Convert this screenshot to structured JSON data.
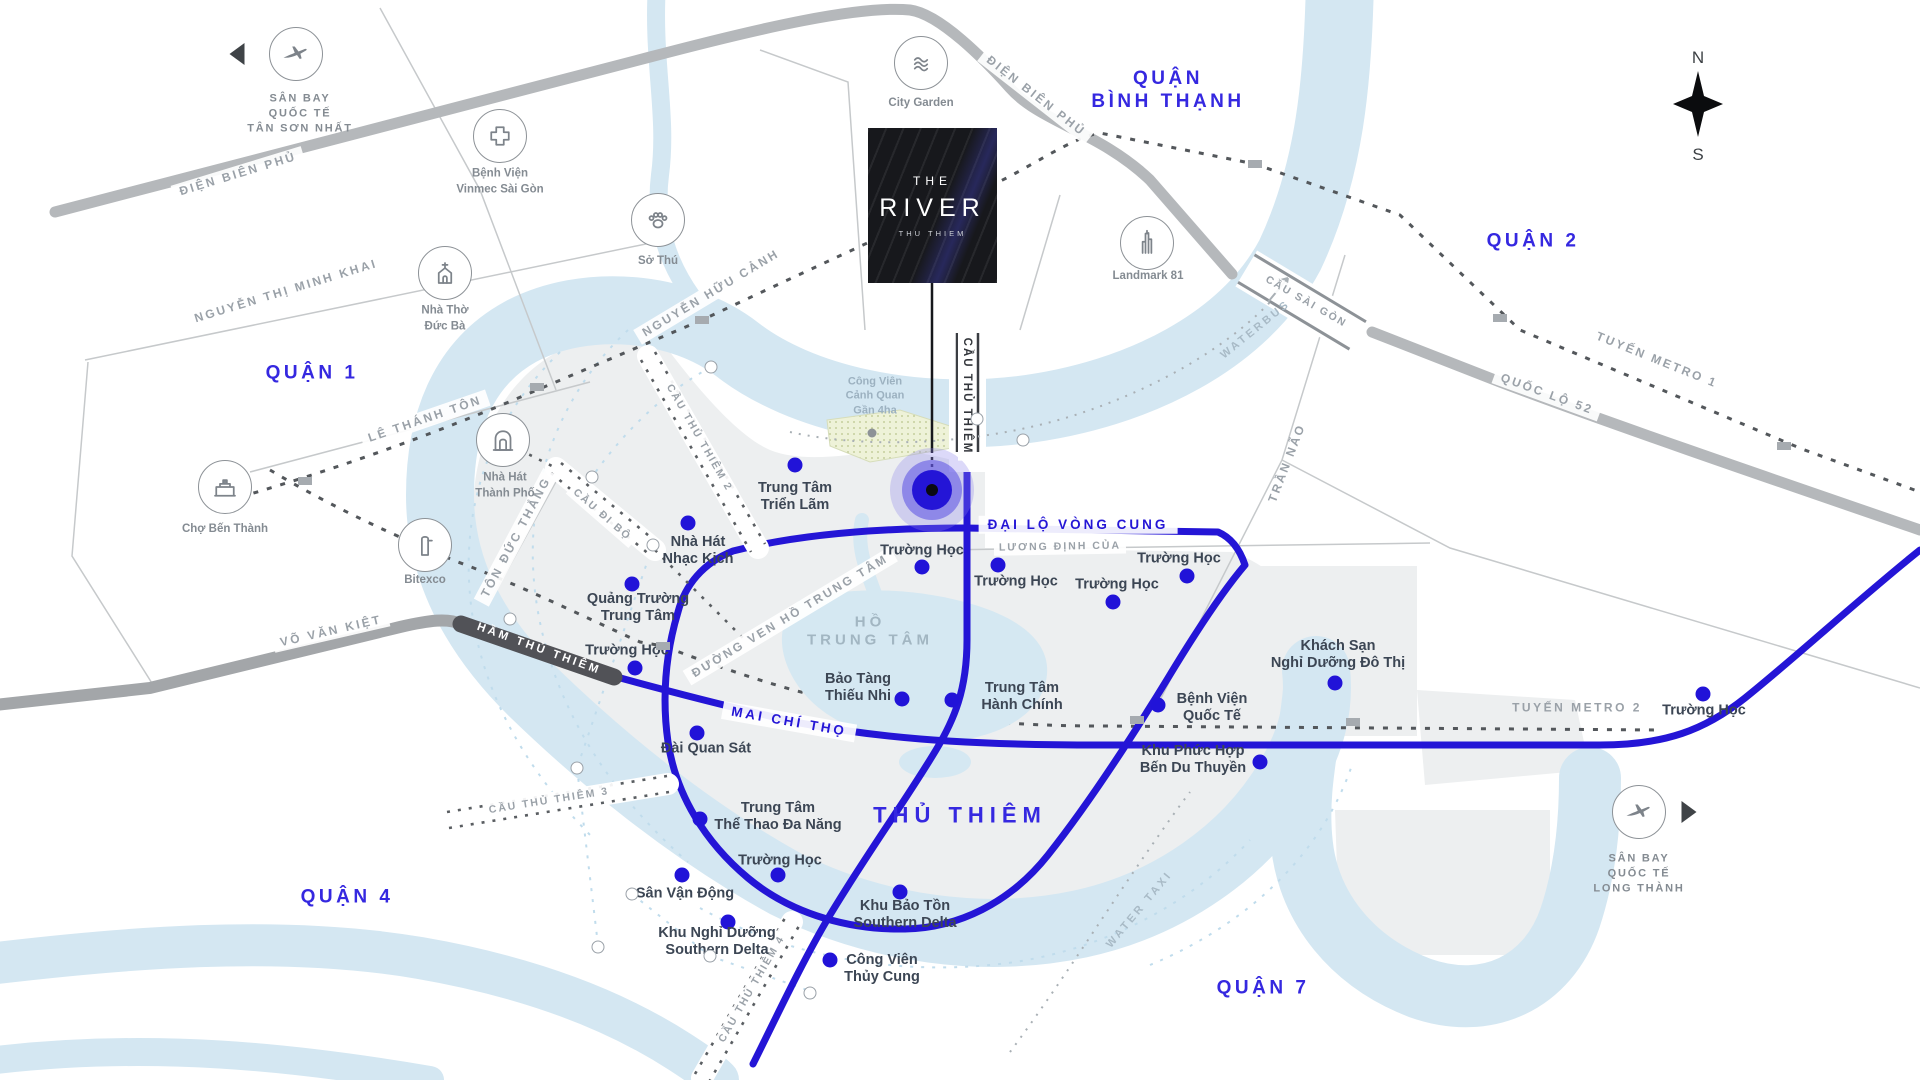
{
  "title": "THE RIVER Thu Thiem location map",
  "logo": {
    "line1": "THE",
    "line2": "RIVER",
    "line3": "THU THIEM"
  },
  "compass": {
    "north": "N",
    "south": "S"
  },
  "colors": {
    "accent_road": "#2415d6",
    "district_text": "#3528e0",
    "river": "#d4e7f2",
    "land": "#edeff0",
    "tunnel": "#515257"
  },
  "districts": [
    {
      "lines": [
        "QUẬN 1"
      ],
      "x": 312,
      "y": 373
    },
    {
      "lines": [
        "QUẬN 2"
      ],
      "x": 1533,
      "y": 241
    },
    {
      "lines": [
        "QUẬN",
        "BÌNH THẠNH"
      ],
      "x": 1168,
      "y": 90
    },
    {
      "lines": [
        "QUẬN 4"
      ],
      "x": 347,
      "y": 897
    },
    {
      "lines": [
        "QUẬN 7"
      ],
      "x": 1263,
      "y": 988
    }
  ],
  "area_labels": [
    {
      "lines": [
        "HỒ",
        "TRUNG TÂM"
      ],
      "x": 870,
      "y": 632,
      "cls": "lake-lbl"
    },
    {
      "lines": [
        "THỦ THIÊM"
      ],
      "x": 960,
      "y": 816,
      "cls": "bigblue"
    },
    {
      "lines": [
        "Công Viên",
        "Cảnh Quan",
        "Gần 4ha"
      ],
      "x": 875,
      "y": 396,
      "cls": "park-lbl"
    }
  ],
  "road_labels": [
    {
      "t": "ĐIỆN BIÊN PHỦ",
      "x": 238,
      "y": 174,
      "r": -17,
      "c": ""
    },
    {
      "t": "ĐIỆN BIÊN PHỦ",
      "x": 1036,
      "y": 96,
      "r": 38,
      "c": ""
    },
    {
      "t": "NGUYỄN THỊ MINH KHAI",
      "x": 286,
      "y": 291,
      "r": -17,
      "c": ""
    },
    {
      "t": "NGUYỄN HỮU CẢNH",
      "x": 711,
      "y": 293,
      "r": -31,
      "c": ""
    },
    {
      "t": "LÊ THÁNH TÔN",
      "x": 425,
      "y": 419,
      "r": -19,
      "c": ""
    },
    {
      "t": "TÔN ĐỨC THẮNG",
      "x": 516,
      "y": 537,
      "r": -62,
      "c": ""
    },
    {
      "t": "VÕ VĂN KIỆT",
      "x": 331,
      "y": 631,
      "r": -13,
      "c": ""
    },
    {
      "t": "QUỐC LỘ 52",
      "x": 1547,
      "y": 394,
      "r": 20,
      "c": ""
    },
    {
      "t": "CẦU SÀI GÒN",
      "x": 1306,
      "y": 302,
      "r": 30,
      "c": "gs"
    },
    {
      "t": "TUYẾN METRO 1",
      "x": 1657,
      "y": 360,
      "r": 22,
      "c": "gn"
    },
    {
      "t": "TUYẾN METRO 2",
      "x": 1577,
      "y": 708,
      "r": 0,
      "c": "gn"
    },
    {
      "t": "TRẦN NÃO",
      "x": 1287,
      "y": 463,
      "r": -69,
      "c": "gn"
    },
    {
      "t": "LƯƠNG ĐỊNH CỦA",
      "x": 1060,
      "y": 547,
      "r": -1,
      "c": "gs"
    },
    {
      "t": "ĐƯỜNG VEN HỒ TRUNG TÂM",
      "x": 790,
      "y": 616,
      "r": -31,
      "c": ""
    },
    {
      "t": "WATERBUS",
      "x": 1256,
      "y": 330,
      "r": -39,
      "c": "w"
    },
    {
      "t": "WATER TAXI",
      "x": 1140,
      "y": 910,
      "r": -50,
      "c": "w"
    },
    {
      "t": "CẦU ĐI BỘ",
      "x": 602,
      "y": 515,
      "r": 41,
      "c": "gs"
    },
    {
      "t": "CẦU THỦ THIÊM 2",
      "x": 699,
      "y": 438,
      "r": 60,
      "c": "gs"
    },
    {
      "t": "CẦU THỦ THIÊM 3",
      "x": 549,
      "y": 801,
      "r": -9,
      "c": "gs"
    },
    {
      "t": "CẦU THỦ THIÊM 4",
      "x": 752,
      "y": 989,
      "r": -60,
      "c": "gs"
    },
    {
      "t": "MAI CHÍ THỌ",
      "x": 789,
      "y": 722,
      "r": 10,
      "c": "b"
    },
    {
      "t": "ĐẠI LỘ VÒNG CUNG",
      "x": 1078,
      "y": 525,
      "r": 0,
      "c": "b"
    },
    {
      "t": "HẦM THỦ THIÊM",
      "x": 539,
      "y": 649,
      "r": 20,
      "c": "tun"
    },
    {
      "t": "CẦU THỦ THIÊM",
      "x": 967,
      "y": 396,
      "r": 0,
      "c": "vert"
    }
  ],
  "pois": [
    {
      "lines": [
        "Trung Tâm",
        "Triển Lãm"
      ],
      "dx": 795,
      "dy": 465,
      "lx": 795,
      "ly": 497
    },
    {
      "lines": [
        "Nhà Hát",
        "Nhạc Kịch"
      ],
      "dx": 688,
      "dy": 523,
      "lx": 698,
      "ly": 551
    },
    {
      "lines": [
        "Quảng Trường",
        "Trung Tâm"
      ],
      "dx": 632,
      "dy": 584,
      "lx": 638,
      "ly": 608
    },
    {
      "lines": [
        "Trường Học"
      ],
      "dx": 635,
      "dy": 668,
      "lx": 627,
      "ly": 651
    },
    {
      "lines": [
        "Bảo Tàng",
        "Thiếu Nhi"
      ],
      "dx": 902,
      "dy": 699,
      "lx": 858,
      "ly": 688
    },
    {
      "lines": [
        "Trung Tâm",
        "Hành Chính"
      ],
      "dx": 952,
      "dy": 700,
      "lx": 1022,
      "ly": 697
    },
    {
      "lines": [
        "Trường Học"
      ],
      "dx": 922,
      "dy": 567,
      "lx": 922,
      "ly": 551
    },
    {
      "lines": [
        "Trường Học"
      ],
      "dx": 998,
      "dy": 565,
      "lx": 1016,
      "ly": 582
    },
    {
      "lines": [
        "Trường Học"
      ],
      "dx": 1113,
      "dy": 602,
      "lx": 1117,
      "ly": 585
    },
    {
      "lines": [
        "Trường Học"
      ],
      "dx": 1187,
      "dy": 576,
      "lx": 1179,
      "ly": 559
    },
    {
      "lines": [
        "Trường Học"
      ],
      "dx": 1703,
      "dy": 694,
      "lx": 1704,
      "ly": 711
    },
    {
      "lines": [
        "Bệnh Viện",
        "Quốc Tế"
      ],
      "dx": 1158,
      "dy": 705,
      "lx": 1212,
      "ly": 708
    },
    {
      "lines": [
        "Khách Sạn",
        "Nghỉ Dưỡng Đô Thị"
      ],
      "dx": 1335,
      "dy": 683,
      "lx": 1338,
      "ly": 655
    },
    {
      "lines": [
        "Khu Phức Hợp",
        "Bến Du Thuyền"
      ],
      "dx": 1260,
      "dy": 762,
      "lx": 1193,
      "ly": 760
    },
    {
      "lines": [
        "Đài Quan Sát"
      ],
      "dx": 697,
      "dy": 733,
      "lx": 706,
      "ly": 749
    },
    {
      "lines": [
        "Trung Tâm",
        "Thể Thao Đa Năng"
      ],
      "dx": 700,
      "dy": 819,
      "lx": 778,
      "ly": 817
    },
    {
      "lines": [
        "Trường Học"
      ],
      "dx": 778,
      "dy": 875,
      "lx": 780,
      "ly": 861
    },
    {
      "lines": [
        "Sân Vận Động"
      ],
      "dx": 682,
      "dy": 875,
      "lx": 685,
      "ly": 894
    },
    {
      "lines": [
        "Khu Nghỉ Dưỡng",
        "Southern Delta"
      ],
      "dx": 728,
      "dy": 922,
      "lx": 717,
      "ly": 942
    },
    {
      "lines": [
        "Khu Bảo Tồn",
        "Southern Delta"
      ],
      "dx": 900,
      "dy": 892,
      "lx": 905,
      "ly": 915
    },
    {
      "lines": [
        "Công Viên",
        "Thủy Cung"
      ],
      "dx": 830,
      "dy": 960,
      "lx": 882,
      "ly": 969
    }
  ],
  "landmarks": [
    {
      "icon": "airplane-icon",
      "lines": [
        "SÂN BAY",
        "QUỐC TẾ",
        "TÂN SƠN NHẤT"
      ],
      "ix": 296,
      "iy": 54,
      "lx": 300,
      "ly": 114,
      "upper": true,
      "arrow": "left",
      "ax": 237,
      "ay": 54
    },
    {
      "icon": "hospital-cross-icon",
      "lines": [
        "Bệnh Viện",
        "Vinmec Sài Gòn"
      ],
      "ix": 500,
      "iy": 136,
      "lx": 500,
      "ly": 182
    },
    {
      "icon": "paw-icon",
      "lines": [
        "Sở Thú"
      ],
      "ix": 658,
      "iy": 220,
      "lx": 658,
      "ly": 262
    },
    {
      "icon": "church-icon",
      "lines": [
        "Nhà Thờ",
        "Đức Bà"
      ],
      "ix": 445,
      "iy": 273,
      "lx": 445,
      "ly": 319
    },
    {
      "icon": "theater-icon",
      "lines": [
        "Nhà Hát",
        "Thành Phố"
      ],
      "ix": 503,
      "iy": 440,
      "lx": 505,
      "ly": 486
    },
    {
      "icon": "market-icon",
      "lines": [
        "Chợ Bến Thành"
      ],
      "ix": 225,
      "iy": 487,
      "lx": 225,
      "ly": 530
    },
    {
      "icon": "tower-icon",
      "lines": [
        "Bitexco"
      ],
      "ix": 425,
      "iy": 545,
      "lx": 425,
      "ly": 581
    },
    {
      "icon": "waves-icon",
      "lines": [
        "City Garden"
      ],
      "ix": 921,
      "iy": 63,
      "lx": 921,
      "ly": 104
    },
    {
      "icon": "skyscraper-icon",
      "lines": [
        "Landmark 81"
      ],
      "ix": 1147,
      "iy": 243,
      "lx": 1148,
      "ly": 277
    },
    {
      "icon": "airplane-icon",
      "lines": [
        "SÂN BAY",
        "QUỐC TẾ",
        "LONG THÀNH"
      ],
      "ix": 1639,
      "iy": 812,
      "lx": 1639,
      "ly": 874,
      "upper": true,
      "arrow": "right",
      "ax": 1689,
      "ay": 812
    }
  ],
  "stations": [
    {
      "x": 537,
      "y": 387
    },
    {
      "x": 702,
      "y": 320
    },
    {
      "x": 1255,
      "y": 164
    },
    {
      "x": 1500,
      "y": 318
    },
    {
      "x": 1784,
      "y": 446
    },
    {
      "x": 663,
      "y": 646
    },
    {
      "x": 1137,
      "y": 720
    },
    {
      "x": 1353,
      "y": 722
    },
    {
      "x": 305,
      "y": 481
    }
  ],
  "nodes": [
    {
      "x": 592,
      "y": 477
    },
    {
      "x": 653,
      "y": 545
    },
    {
      "x": 711,
      "y": 367
    },
    {
      "x": 977,
      "y": 419
    },
    {
      "x": 577,
      "y": 768
    },
    {
      "x": 598,
      "y": 947
    },
    {
      "x": 632,
      "y": 894
    },
    {
      "x": 710,
      "y": 956
    },
    {
      "x": 810,
      "y": 993
    },
    {
      "x": 1023,
      "y": 440
    },
    {
      "x": 510,
      "y": 619
    }
  ],
  "gray_node": {
    "x": 872,
    "y": 433
  },
  "marker": {
    "x": 932,
    "y": 490
  }
}
